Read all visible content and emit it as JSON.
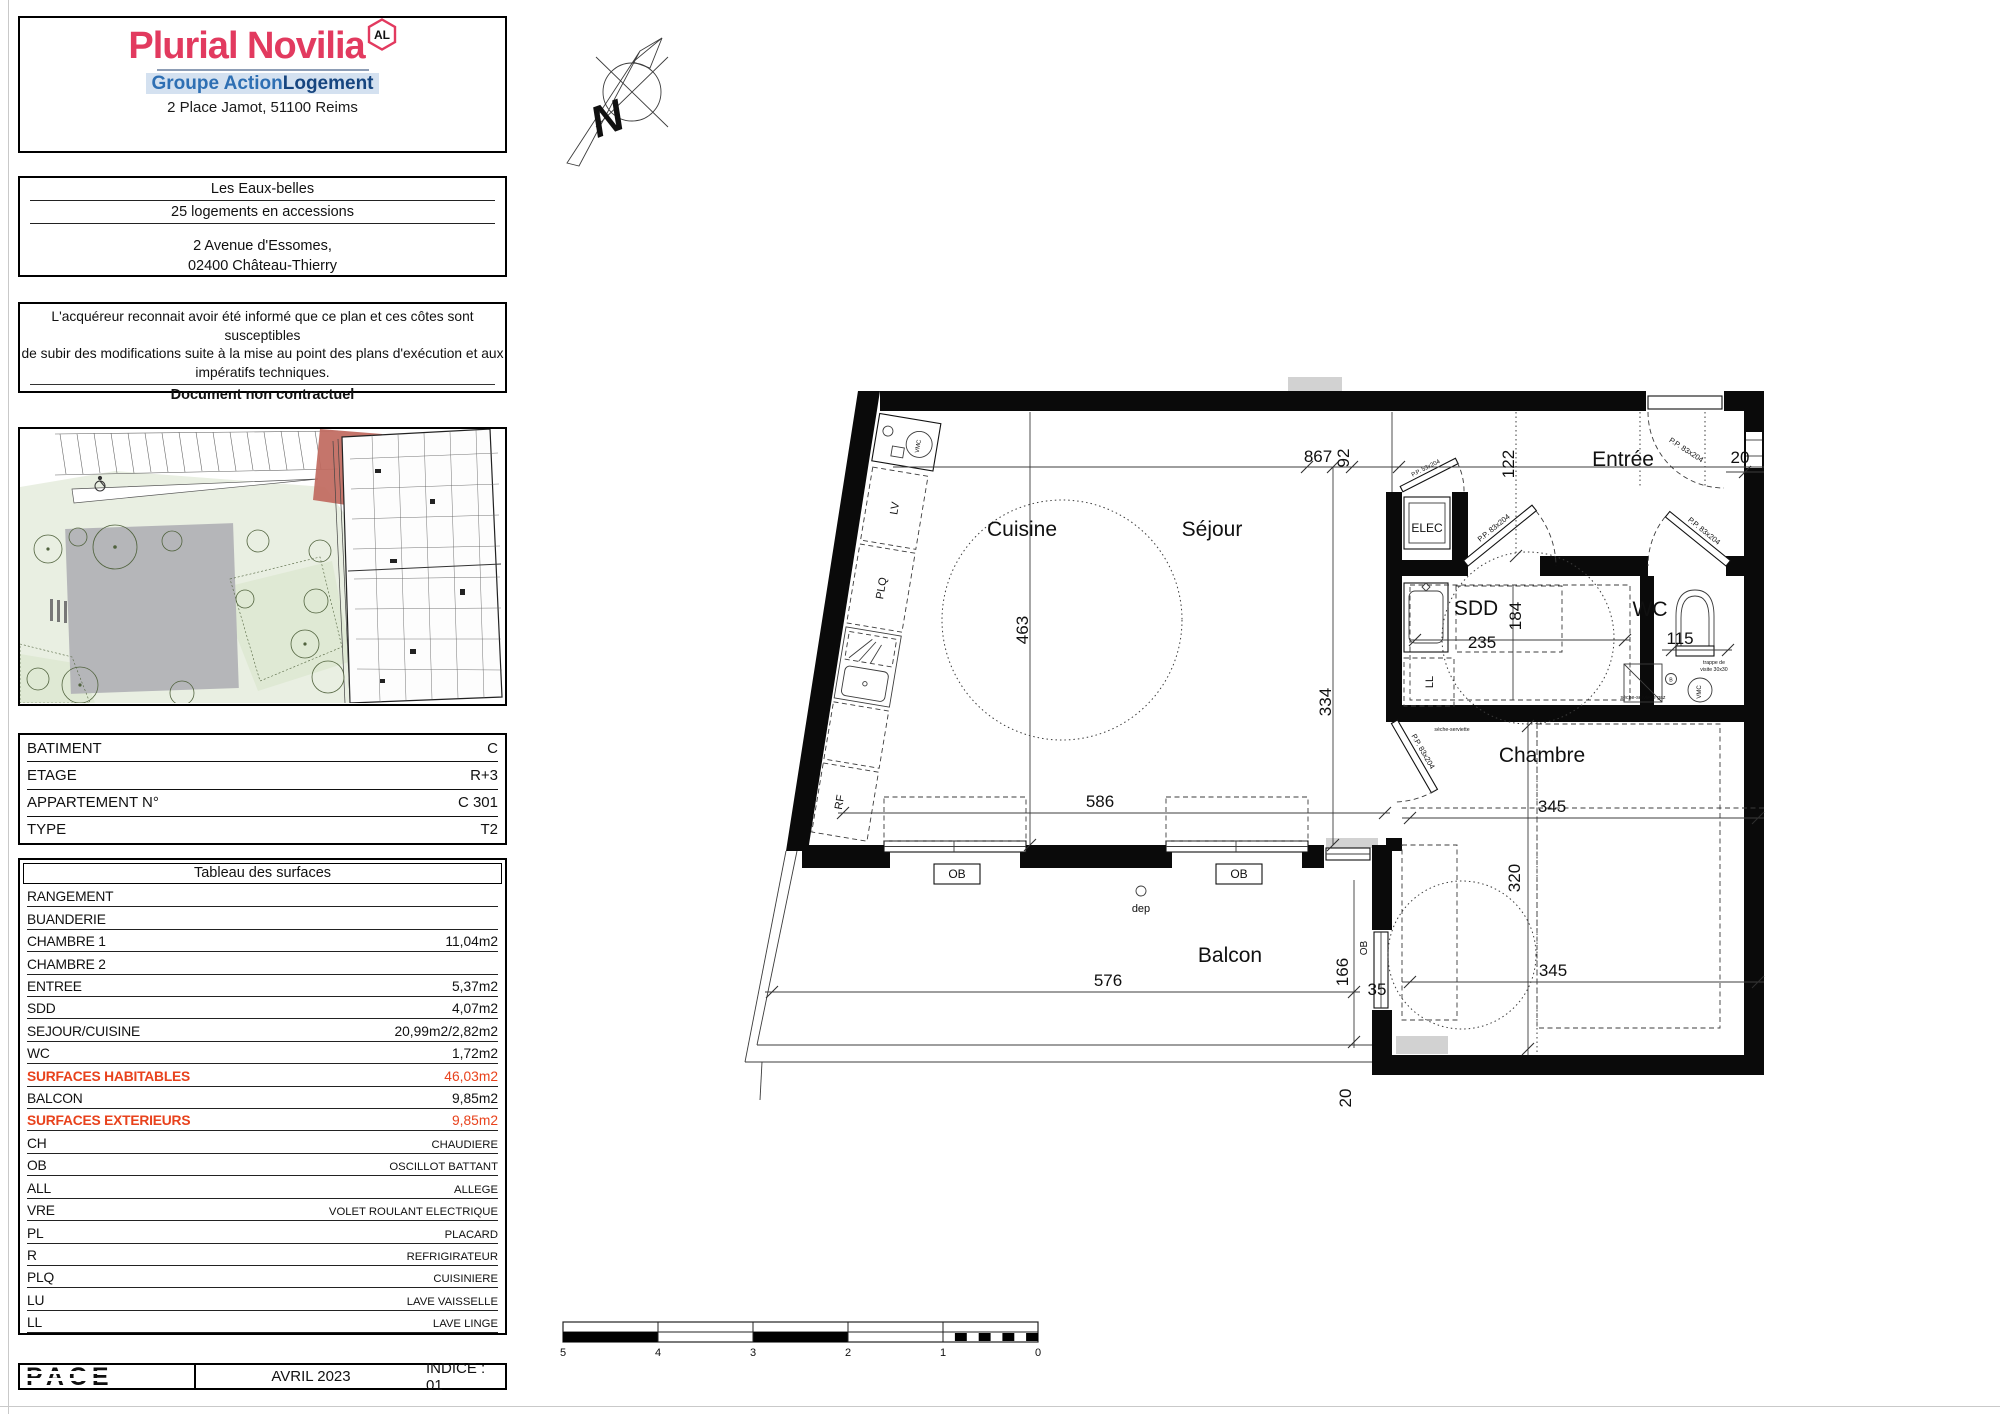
{
  "header": {
    "brand": "Plurial Novilia",
    "badge": "AL",
    "group_light": "Groupe Action",
    "group_dark": "Logement",
    "address": "2 Place Jamot, 51100 Reims"
  },
  "project": {
    "name": "Les Eaux-belles",
    "subtitle": "25 logements en accessions",
    "addr1": "2 Avenue d'Essomes,",
    "addr2": "02400 Château-Thierry"
  },
  "disclaimer": {
    "l1": "L'acquéreur reconnait avoir été informé que ce plan et ces côtes sont susceptibles",
    "l2": "de subir des modifications suite à la mise au point des plans d'exécution et aux",
    "l3": "impératifs techniques.",
    "bold": "Document non contractuel"
  },
  "unit": {
    "rows": [
      {
        "label": "BATIMENT",
        "value": "C"
      },
      {
        "label": "ETAGE",
        "value": "R+3"
      },
      {
        "label": "APPARTEMENT N°",
        "value": "C 301"
      },
      {
        "label": "TYPE",
        "value": "T2"
      }
    ]
  },
  "surfaces": {
    "title": "Tableau des surfaces",
    "rows": [
      {
        "label": "RANGEMENT",
        "value": ""
      },
      {
        "label": "BUANDERIE",
        "value": ""
      },
      {
        "label": "CHAMBRE 1",
        "value": "11,04m2"
      },
      {
        "label": "CHAMBRE 2",
        "value": ""
      },
      {
        "label": "ENTREE",
        "value": "5,37m2"
      },
      {
        "label": "SDD",
        "value": "4,07m2"
      },
      {
        "label": "SEJOUR/CUISINE",
        "value": "20,99m2/2,82m2"
      },
      {
        "label": "WC",
        "value": "1,72m2"
      },
      {
        "label": "SURFACES HABITABLES",
        "value": "46,03m2"
      },
      {
        "label": "BALCON",
        "value": "9,85m2"
      },
      {
        "label": "SURFACES EXTERIEURS",
        "value": "9,85m2"
      },
      {
        "label": "CH",
        "value": "CHAUDIERE"
      },
      {
        "label": "OB",
        "value": "OSCILLOT BATTANT"
      },
      {
        "label": "ALL",
        "value": "ALLEGE"
      },
      {
        "label": "VRE",
        "value": "VOLET ROULANT ELECTRIQUE"
      },
      {
        "label": "PL",
        "value": "PLACARD"
      },
      {
        "label": "R",
        "value": "REFRIGIRATEUR"
      },
      {
        "label": "PLQ",
        "value": "CUISINIERE"
      },
      {
        "label": "LU",
        "value": "LAVE VAISSELLE"
      },
      {
        "label": "LL",
        "value": "LAVE LINGE"
      }
    ]
  },
  "footer": {
    "logo": "PACE",
    "date": "AVRIL 2023",
    "indice": "INDICE : 01"
  },
  "plan": {
    "rooms": {
      "cuisine": "Cuisine",
      "sejour": "Séjour",
      "entree": "Entrée",
      "sdd": "SDD",
      "wc": "WC",
      "chambre": "Chambre",
      "balcon": "Balcon"
    },
    "dims": {
      "d867": "867",
      "d92": "92",
      "d122": "122",
      "d20top": "20",
      "d463": "463",
      "d334": "334",
      "d586": "586",
      "d235": "235",
      "d184": "184",
      "d115": "115",
      "d345a": "345",
      "d320": "320",
      "d345b": "345",
      "d576": "576",
      "d166": "166",
      "d35": "35",
      "d20b": "20"
    },
    "labels": {
      "ob": "OB",
      "dep": "dep",
      "elec": "ELEC",
      "lv": "LV",
      "plq": "PLQ",
      "rf": "RF",
      "ll": "LL",
      "vmc": "VMC",
      "b": "B",
      "pp83": "P.P. 83x204",
      "pp53": "P.P. 53x204",
      "trappe1": "trappe de",
      "trappe2": "visite 30x30",
      "seche": "sèche-serviette",
      "sechegaz": "sèche-serviette gaz",
      "north": "N"
    },
    "scalebar": [
      "5",
      "4",
      "3",
      "2",
      "1",
      "0"
    ]
  },
  "colors": {
    "brand_pink": "#e23a5f",
    "action_blue": "#2e6fb3",
    "action_navy": "#16457f",
    "highlight_red": "#e8421c",
    "site_green": "#e9efe2",
    "site_gray": "#b5b6b9",
    "unit_red": "#c0695e"
  }
}
